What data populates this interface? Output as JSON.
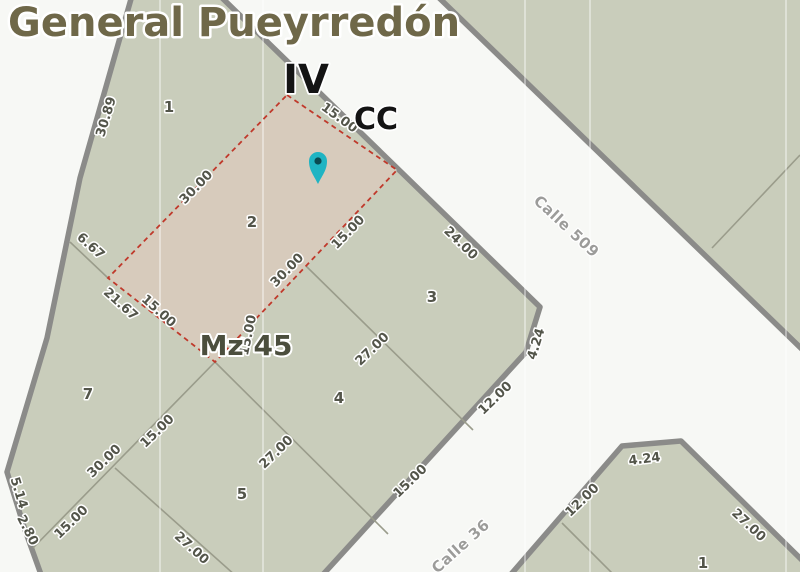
{
  "title": {
    "text": "General Pueyrredón"
  },
  "zone": {
    "district": "IV",
    "circumscription": "CC"
  },
  "block": {
    "label": "Mz 45",
    "label_x": 246,
    "label_y": 355
  },
  "marker": {
    "x": 318,
    "y": 161,
    "tip_y": 184
  },
  "streets": [
    {
      "name": "Calle 509",
      "x": 563,
      "y": 230,
      "rot": 43
    },
    {
      "name": "Calle 36",
      "x": 464,
      "y": 550,
      "rot": -42
    }
  ],
  "parcel_numbers": [
    {
      "n": "1",
      "x": 169,
      "y": 112
    },
    {
      "n": "2",
      "x": 252,
      "y": 227
    },
    {
      "n": "3",
      "x": 432,
      "y": 302
    },
    {
      "n": "4",
      "x": 339,
      "y": 403
    },
    {
      "n": "5",
      "x": 242,
      "y": 499
    },
    {
      "n": "7",
      "x": 88,
      "y": 399
    },
    {
      "n": "1",
      "x": 703,
      "y": 568
    }
  ],
  "dimensions": [
    {
      "t": "30.89",
      "x": 110,
      "y": 118,
      "r": -73
    },
    {
      "t": "6.67",
      "x": 88,
      "y": 249,
      "r": 42
    },
    {
      "t": "30.00",
      "x": 199,
      "y": 190,
      "r": -46
    },
    {
      "t": "15.00",
      "x": 337,
      "y": 121,
      "r": 36
    },
    {
      "t": "15.00",
      "x": 351,
      "y": 235,
      "r": -46
    },
    {
      "t": "30.00",
      "x": 290,
      "y": 273,
      "r": -46
    },
    {
      "t": "21.67",
      "x": 118,
      "y": 307,
      "r": 42
    },
    {
      "t": "15.00",
      "x": 156,
      "y": 314,
      "r": 42
    },
    {
      "t": "15.00",
      "x": 252,
      "y": 336,
      "r": -78
    },
    {
      "t": "24.00",
      "x": 458,
      "y": 246,
      "r": 44
    },
    {
      "t": "4.24",
      "x": 540,
      "y": 345,
      "r": -73
    },
    {
      "t": "12.00",
      "x": 498,
      "y": 401,
      "r": -44
    },
    {
      "t": "27.00",
      "x": 375,
      "y": 352,
      "r": -44
    },
    {
      "t": "27.00",
      "x": 279,
      "y": 455,
      "r": -44
    },
    {
      "t": "15.00",
      "x": 413,
      "y": 484,
      "r": -44
    },
    {
      "t": "15.00",
      "x": 74,
      "y": 525,
      "r": -44
    },
    {
      "t": "30.00",
      "x": 107,
      "y": 464,
      "r": -44
    },
    {
      "t": "15.00",
      "x": 160,
      "y": 434,
      "r": -44
    },
    {
      "t": "27.00",
      "x": 189,
      "y": 551,
      "r": 42
    },
    {
      "t": "5.14",
      "x": 15,
      "y": 494,
      "r": 73
    },
    {
      "t": "2.80",
      "x": 24,
      "y": 532,
      "r": 63
    },
    {
      "t": "4.24",
      "x": 645,
      "y": 463,
      "r": -7
    },
    {
      "t": "12.00",
      "x": 585,
      "y": 503,
      "r": -44
    },
    {
      "t": "27.00",
      "x": 746,
      "y": 528,
      "r": 43
    }
  ],
  "geometry": {
    "blocks": [
      {
        "name": "block-mz45",
        "points": "133,-8 216,-8 540,307 526,352 318,580 43,580 25,530 7,472 47,338 80,178"
      },
      {
        "name": "block-northeast",
        "points": "433,-8 808,-8 808,355"
      },
      {
        "name": "block-southeast",
        "points": "622,446 681,441 808,566 808,580 506,580"
      }
    ],
    "selected_parcel": {
      "number": "2",
      "points": "287,95 397,170 215,362 108,278"
    },
    "parcel_lines": [
      "70,242 108,278",
      "215,362 388,534",
      "306,266 473,430",
      "33,548 215,362",
      "115,468 236,576",
      "712,248 800,155",
      "562,523 619,580"
    ],
    "graticule_x": [
      160,
      263,
      525,
      590,
      786
    ]
  },
  "colors": {
    "bg": "#f7f8f5",
    "block_fill": "#c9cdbb",
    "selected_fill": "#d7cbbc",
    "border": "#8b8b89",
    "parcel_line": "#9a9c8b",
    "selected_outline": "#c0392b",
    "graticule": "rgba(255,255,255,0.4)",
    "marker": "#1fb4c3",
    "marker_dot": "#0a4a52",
    "title_color": "#6f6849",
    "zone_color": "#141414",
    "mz_color": "#4b4e3d",
    "dim_color": "#53554a",
    "street_color": "#9c9c9a"
  }
}
